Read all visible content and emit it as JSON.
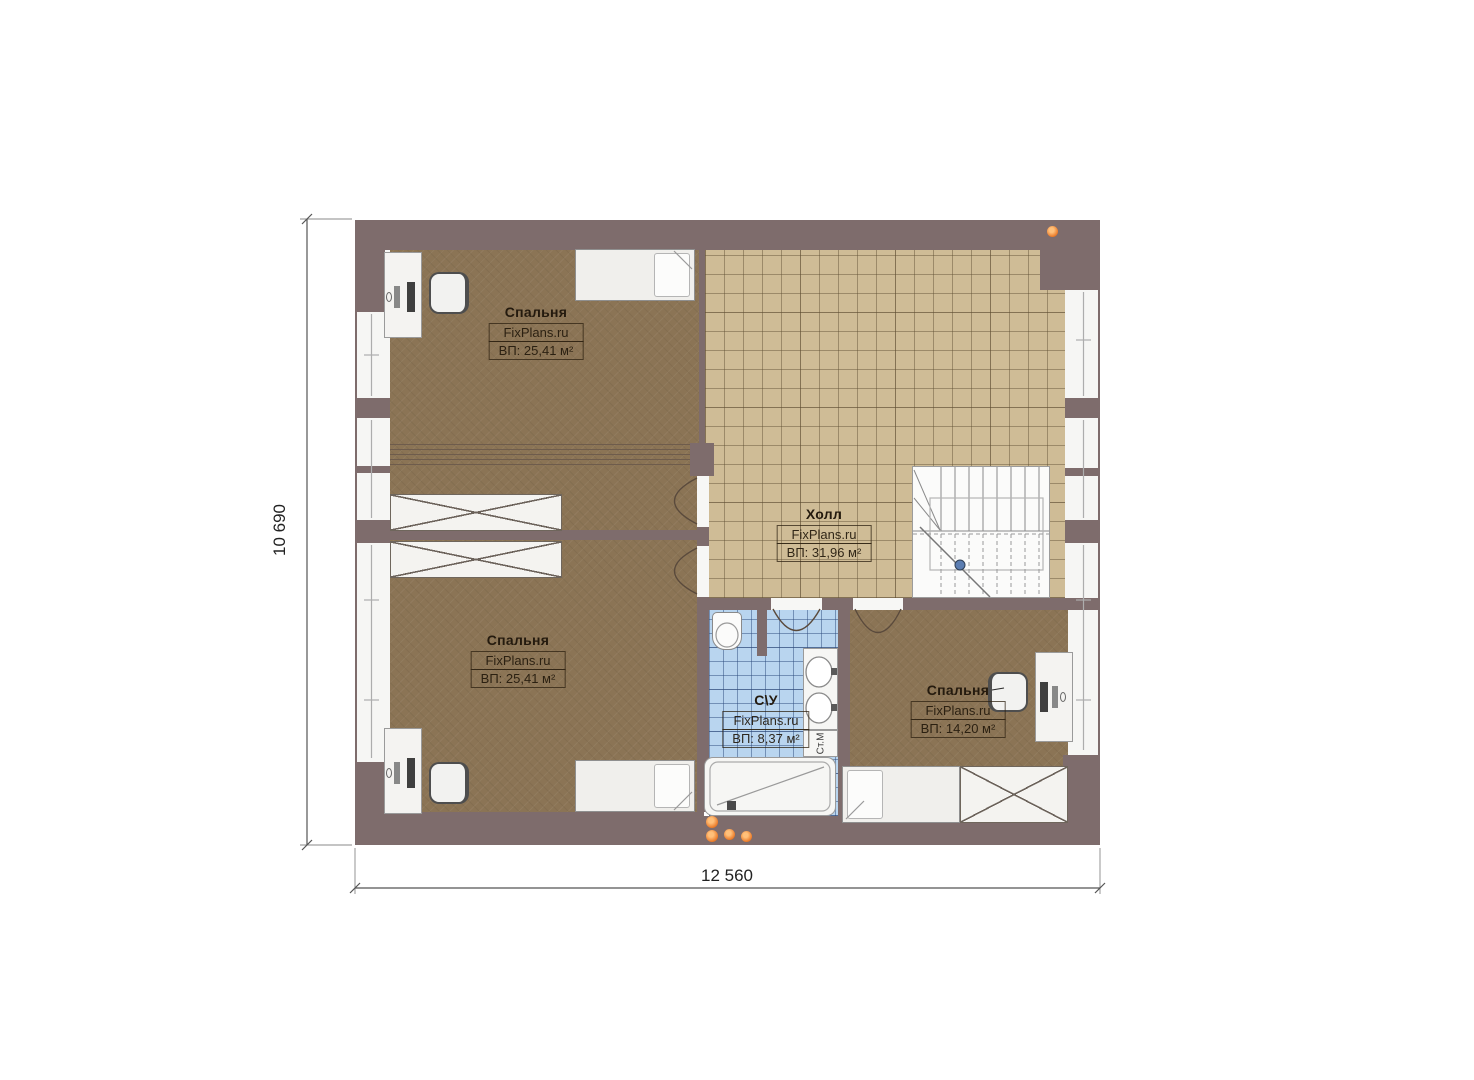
{
  "plan": {
    "dimensions": {
      "width": "12 560",
      "height": "10 690"
    },
    "rooms": {
      "bedroom_top_left": {
        "name": "Спальня",
        "watermark": "FixPlans.ru",
        "area": "ВП: 25,41 м²"
      },
      "bedroom_bottom_left": {
        "name": "Спальня",
        "watermark": "FixPlans.ru",
        "area": "ВП: 25,41 м²"
      },
      "bedroom_right": {
        "name": "Спальня",
        "watermark": "FixPlans.ru",
        "area": "ВП: 14,20 м²"
      },
      "hall": {
        "name": "Холл",
        "watermark": "FixPlans.ru",
        "area": "ВП: 31,96 м²"
      },
      "bathroom": {
        "name": "С\\У",
        "watermark": "FixPlans.ru",
        "area": "ВП: 8,37 м²"
      }
    },
    "labels": {
      "washing_machine": "Ст.М"
    },
    "colors": {
      "wall": "#7e6c6c",
      "carpet": "#8b7455",
      "tile_hall": "#cfbc96",
      "tile_bath": "#b9d5ef",
      "furniture": "#f2f2f0",
      "marker_orange": "#ea7a28"
    }
  }
}
